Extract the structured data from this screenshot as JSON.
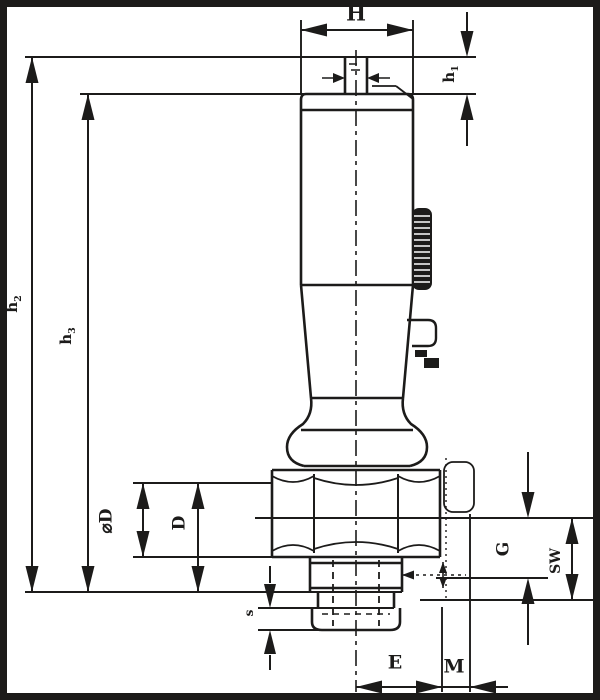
{
  "drawing": {
    "title": "dimensional-drawing-knob-plunger",
    "ink_color": "#1c1b1a",
    "background_color": "#ffffff",
    "labels": {
      "H": "H",
      "h1": {
        "base": "h",
        "sub": "1"
      },
      "h2": {
        "base": "h",
        "sub": "2"
      },
      "h3": {
        "base": "h",
        "sub": "3"
      },
      "dia_D": "⌀D",
      "D": "D",
      "G": "G",
      "SW": "SW",
      "s": "s",
      "E": "E",
      "M": "M"
    }
  }
}
